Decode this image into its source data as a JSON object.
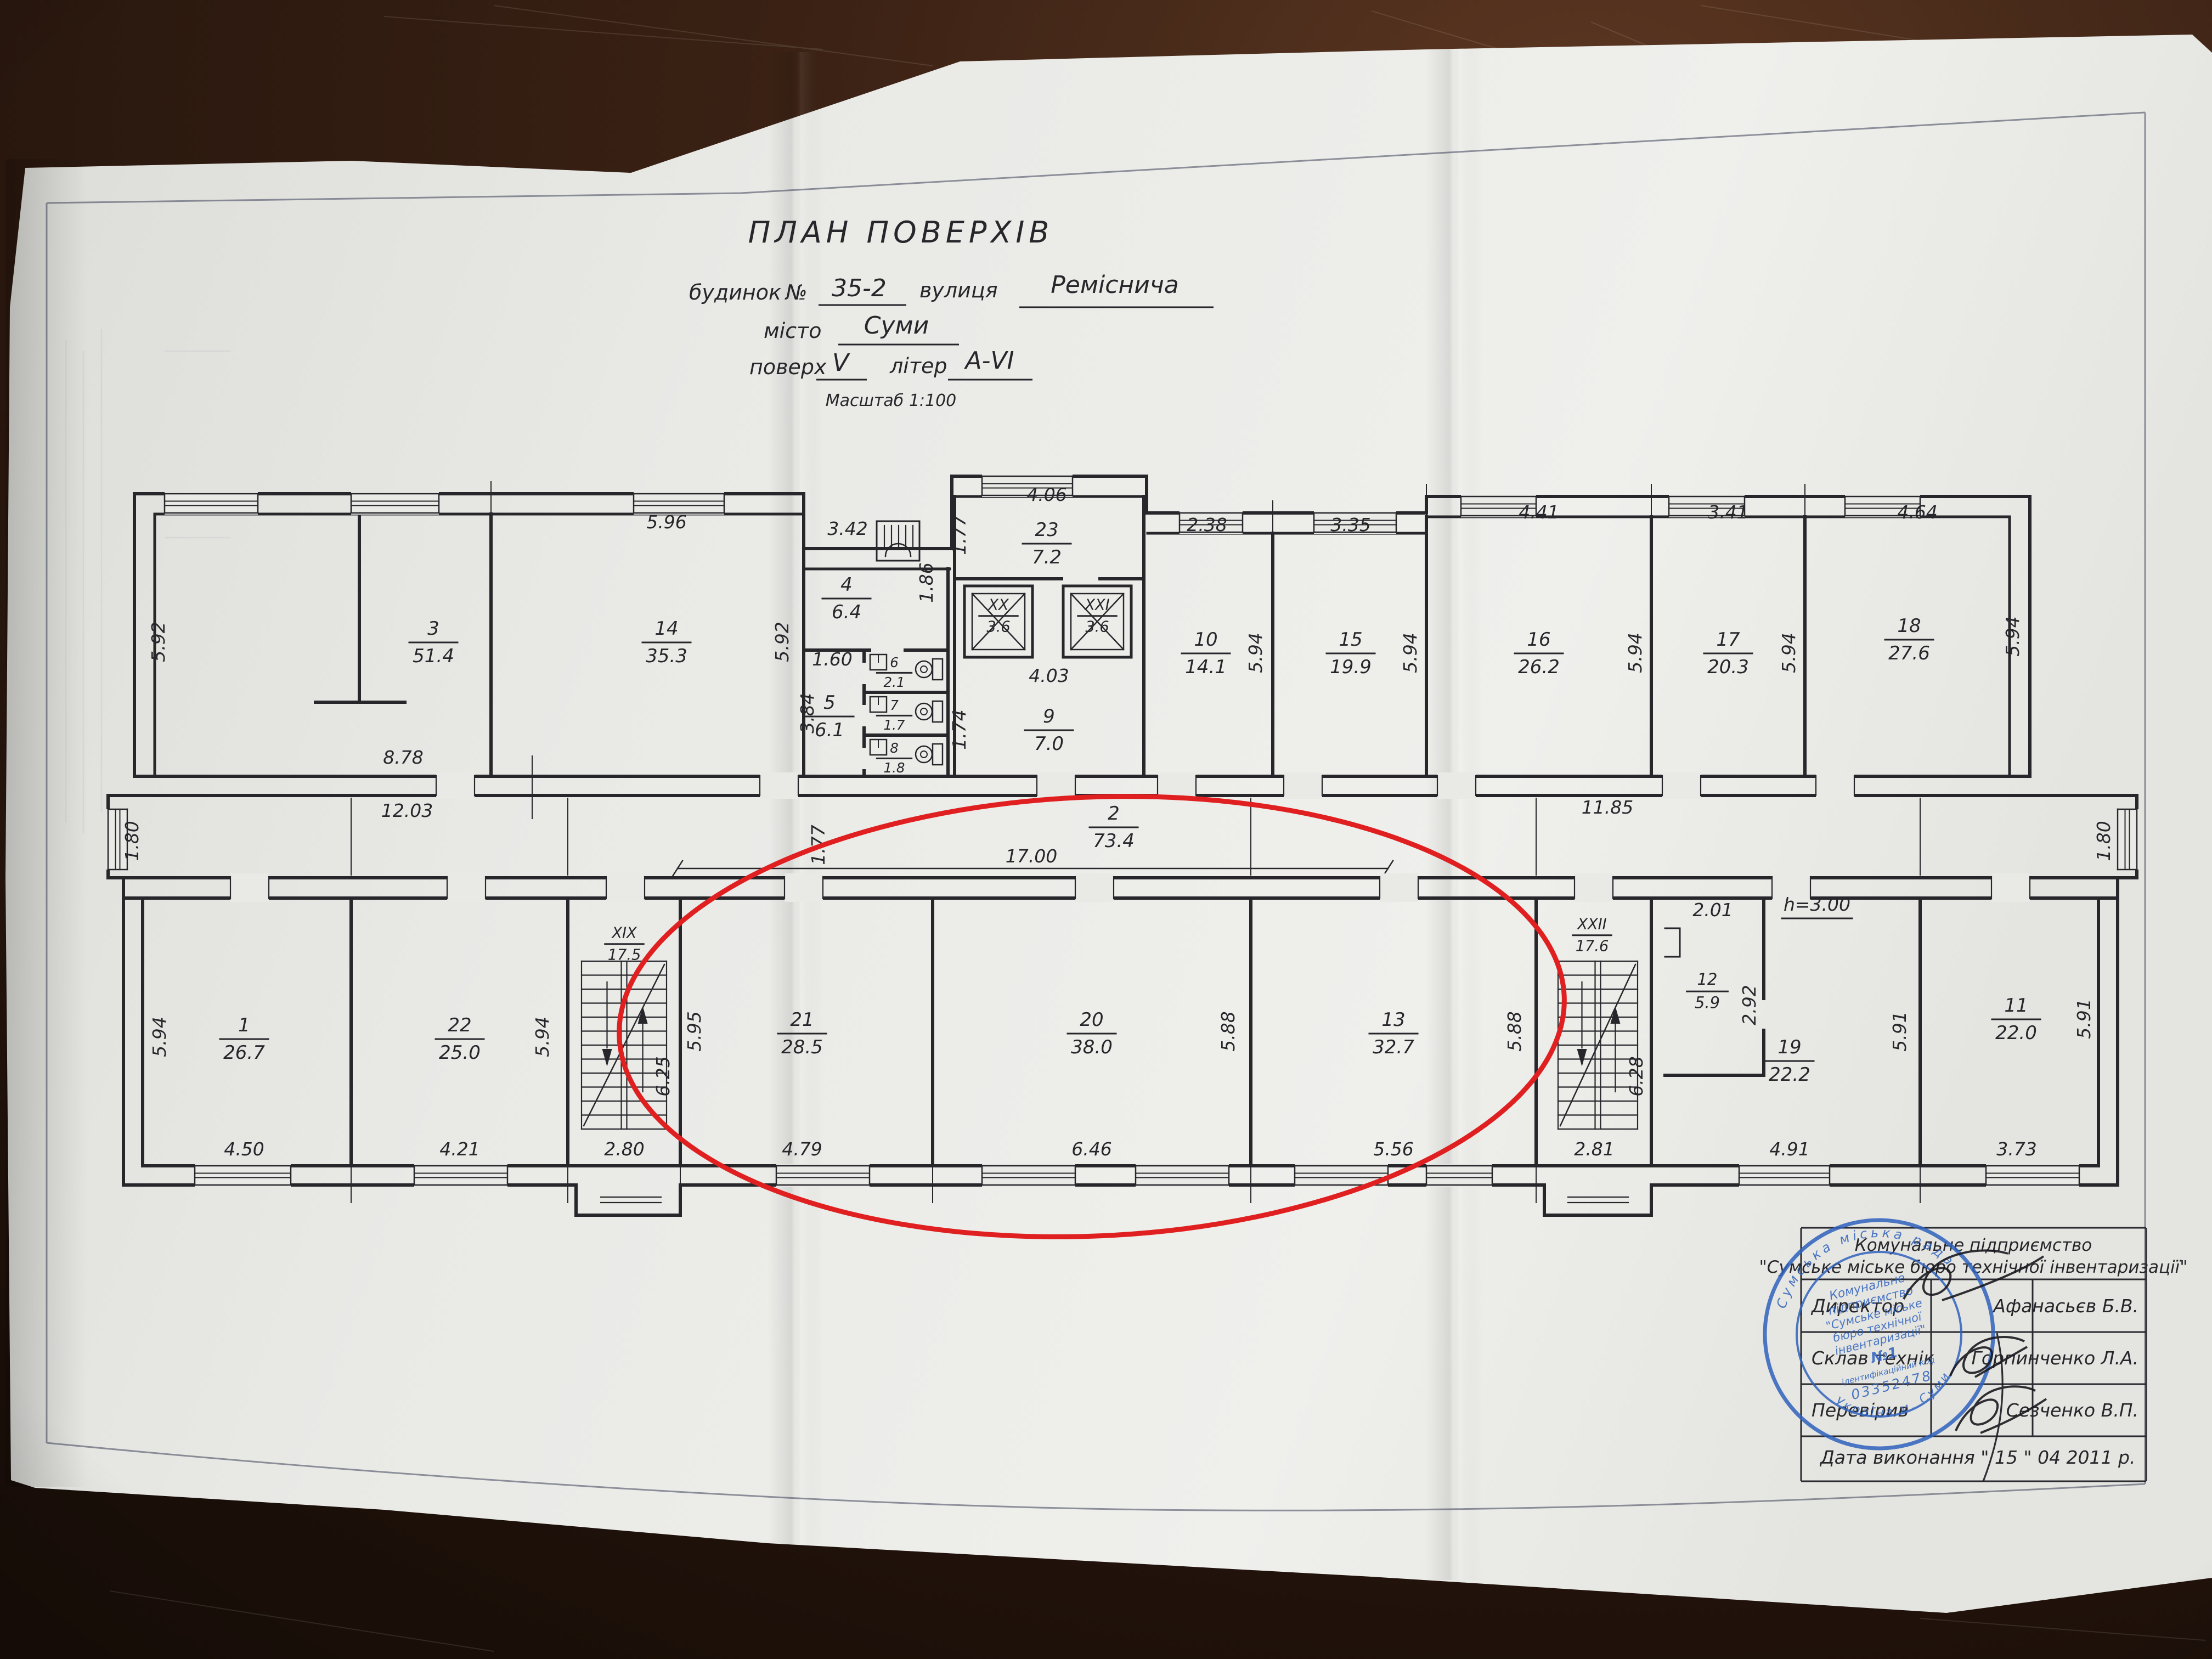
{
  "title": {
    "heading": "ПЛАН ПОВЕРХІВ",
    "house_label": "будинок",
    "number_sign": "№",
    "house_value": "35-2",
    "street_label": "вулиця",
    "street_value": "Реміснича",
    "city_label": "місто",
    "city_value": "Суми",
    "floor_label": "поверх",
    "floor_value": "V",
    "letter_label": "літер",
    "letter_value": "А-VI",
    "scale_note": "Масштаб 1:100"
  },
  "rooms": [
    {
      "num": "3",
      "area": "51.4"
    },
    {
      "num": "14",
      "area": "35.3"
    },
    {
      "num": "4",
      "area": "6.4"
    },
    {
      "num": "5",
      "area": "6.1"
    },
    {
      "num": "6",
      "area": "2.1"
    },
    {
      "num": "7",
      "area": "1.7"
    },
    {
      "num": "8",
      "area": "1.8"
    },
    {
      "num": "23",
      "area": "7.2"
    },
    {
      "num": "XX",
      "area": "3.6"
    },
    {
      "num": "XXI",
      "area": "3.6"
    },
    {
      "num": "9",
      "area": "7.0"
    },
    {
      "num": "10",
      "area": "14.1"
    },
    {
      "num": "15",
      "area": "19.9"
    },
    {
      "num": "16",
      "area": "26.2"
    },
    {
      "num": "17",
      "area": "20.3"
    },
    {
      "num": "18",
      "area": "27.6"
    },
    {
      "num": "2",
      "area": "73.4"
    },
    {
      "num": "1",
      "area": "26.7"
    },
    {
      "num": "22",
      "area": "25.0"
    },
    {
      "num": "XIX",
      "area": "17.5"
    },
    {
      "num": "21",
      "area": "28.5"
    },
    {
      "num": "20",
      "area": "38.0"
    },
    {
      "num": "13",
      "area": "32.7"
    },
    {
      "num": "XXII",
      "area": "17.6"
    },
    {
      "num": "12",
      "area": "5.9"
    },
    {
      "num": "19",
      "area": "22.2"
    },
    {
      "num": "11",
      "area": "22.0"
    }
  ],
  "dims": [
    "5.92",
    "8.78",
    "5.96",
    "5.92",
    "3.42",
    "1.86",
    "1.60",
    "3.84",
    "4.06",
    "1.77",
    "4.03",
    "1.74",
    "2.38",
    "3.35",
    "4.41",
    "3.41",
    "4.64",
    "5.94",
    "5.94",
    "5.94",
    "5.94",
    "5.94",
    "12.03",
    "17.00",
    "11.85",
    "1.80",
    "1.80",
    "1.77",
    "5.94",
    "4.50",
    "4.21",
    "5.94",
    "2.80",
    "6.25",
    "5.95",
    "4.79",
    "6.46",
    "5.88",
    "5.56",
    "5.88",
    "2.81",
    "6.28",
    "2.01",
    "2.92",
    "4.91",
    "5.91",
    "3.73",
    "5.91",
    "h=3.00"
  ],
  "stamp_table": {
    "header_line1": "Комунальне підприємство",
    "header_line2": "\"Сумське міське бюро технічної інвентаризації\"",
    "rows": [
      {
        "label": "Директор",
        "name": "Афанасьєв Б.В."
      },
      {
        "label": "Склав технік",
        "name": "Горпинченко Л.А."
      },
      {
        "label": "Перевірив",
        "name": "Сезченко В.П."
      }
    ],
    "date_row": "Дата виконання  \" 15 \"   04     2011 р."
  },
  "seal": {
    "ring_top": "Сумська міська рада",
    "ring_bottom": "Україна м. Суми",
    "lines": [
      "Комунальне",
      "підприємство",
      "\"Сумське міське",
      "бюро технічної",
      "інвентаризації\"",
      "№1",
      "ідентифікаційний код",
      "03352478"
    ]
  },
  "colors": {
    "paper": "#e9e9e6",
    "ink": "#26262b",
    "red_highlight": "#e02020",
    "seal_blue": "#2f62bd"
  }
}
